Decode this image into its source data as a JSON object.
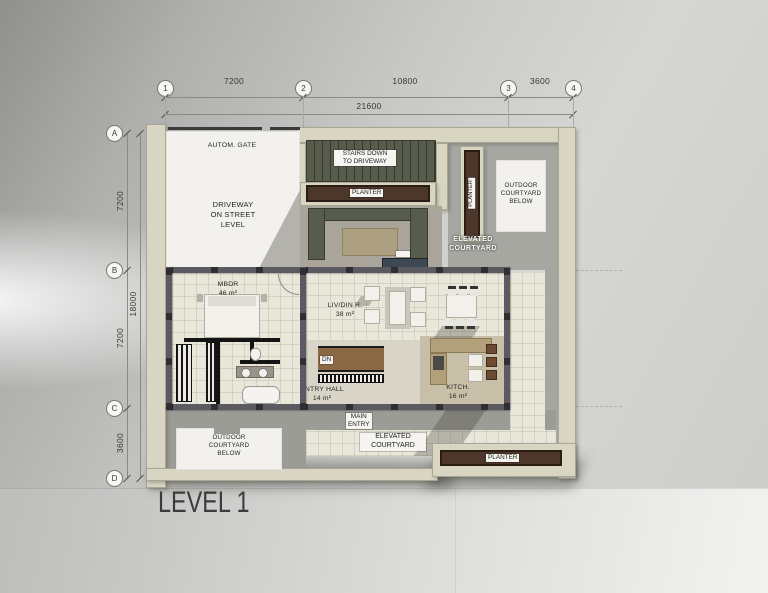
{
  "title": "LEVEL 1",
  "grid": {
    "cols": [
      "1",
      "2",
      "3",
      "4"
    ],
    "col_dims": [
      "7200",
      "10800",
      "3600"
    ],
    "col_total": "21600",
    "rows": [
      "A",
      "B",
      "C",
      "D"
    ],
    "row_dims": [
      "7200",
      "7200",
      "3600"
    ],
    "row_total": "18000"
  },
  "labels": {
    "autom_gate": "AUTOM. GATE",
    "driveway": "DRIVEWAY\nON STREET\nLEVEL",
    "stairs_down": "STAIRS DOWN\nTO DRIVEWAY",
    "planter_top": "PLANTER",
    "planter_right": "PLANTER",
    "planter_bottom": "PLANTER",
    "outdoor_courtyard_top_right": "OUTDOOR\nCOURTYARD\nBELOW",
    "outdoor_courtyard_bottom_left": "OUTDOOR\nCOURTYARD\nBELOW",
    "elevated_courtyard_upper": "ELEVATED\nCOURTYARD",
    "elevated_courtyard_lower": "ELEVATED\nCOURTYARD",
    "main_entry": "MAIN\nENTRY",
    "dn": "DN"
  },
  "rooms": [
    {
      "name": "MBDR",
      "area": "46 m²"
    },
    {
      "name": "LIV/DIN R.",
      "area": "38 m²"
    },
    {
      "name": "ENTRY HALL",
      "area": "14 m²"
    },
    {
      "name": "KITCH.",
      "area": "16 m²"
    }
  ],
  "colors": {
    "wall_beige": "#d8d5c2",
    "floor_cream": "#e9e7d9",
    "concrete_gray": "#a7a7a2",
    "planter_brown": "#4c372a",
    "stair_olive": "#575c4d",
    "wood": "#8a6a45",
    "wall_dark": "#55555a"
  }
}
